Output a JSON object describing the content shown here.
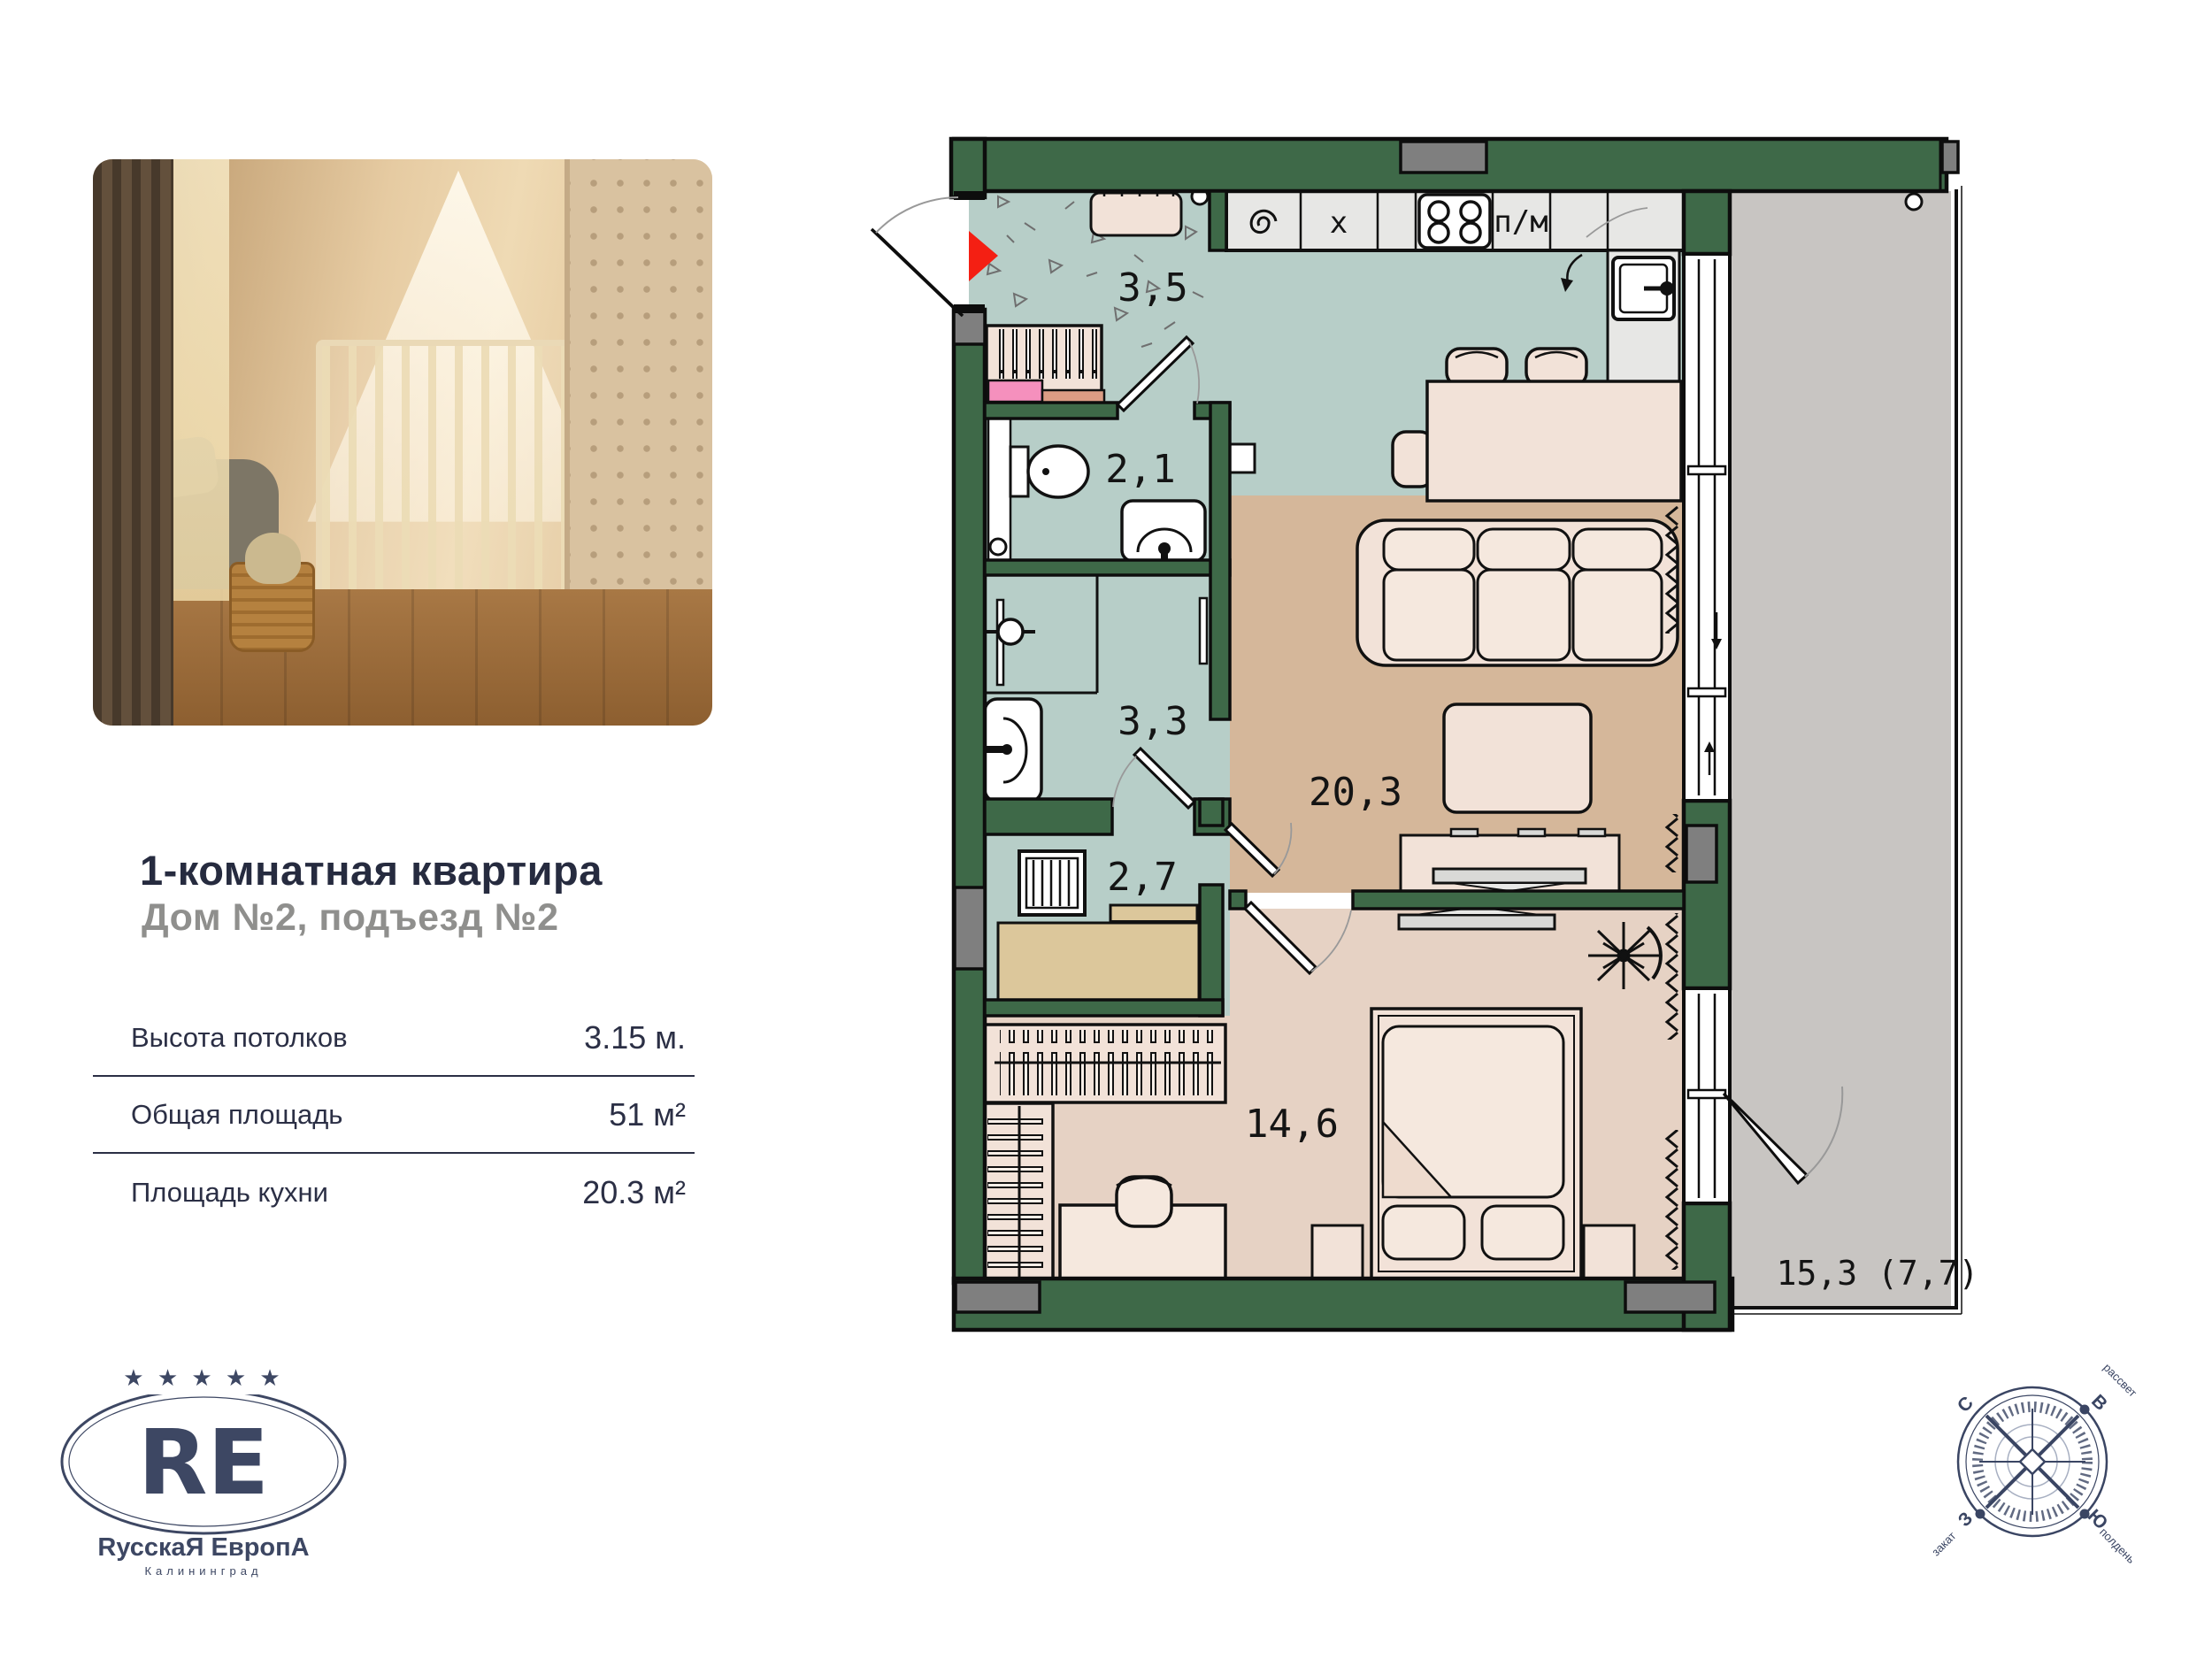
{
  "card": {
    "title": "1-комнатная квартира",
    "subtitle": "Дом №2, подъезд №2",
    "specs": [
      {
        "label": "Высота потолков",
        "value": "3.15 м."
      },
      {
        "label": "Общая площадь",
        "value": "51 м²"
      },
      {
        "label": "Площадь кухни",
        "value": "20.3 м²"
      }
    ]
  },
  "logo": {
    "stars": "★ ★ ★ ★ ★",
    "monogram": "RE",
    "name": "RусскаЯ ЕвропА",
    "city": "Калининград"
  },
  "plan": {
    "rooms": [
      {
        "id": "hallway",
        "label": "3,5"
      },
      {
        "id": "bathroom",
        "label": "2,1"
      },
      {
        "id": "shower-room",
        "label": "3,3"
      },
      {
        "id": "storage",
        "label": "2,7"
      },
      {
        "id": "kitchen-living",
        "label": "20,3"
      },
      {
        "id": "bedroom",
        "label": "14,6"
      },
      {
        "id": "balcony",
        "label": "15,3 (7,7)"
      }
    ],
    "kitchen": {
      "dishwasher": "п/м",
      "appliance_x": "x"
    },
    "compass": {
      "north": "С",
      "east": "В",
      "west": "З",
      "south": "Ю",
      "dawn": "рассвет",
      "sunset": "закат",
      "noon": "полдень"
    },
    "colors": {
      "wall_green": "#3e6948",
      "wet_floor": "#b7cec8",
      "living_floor": "#d5b79a",
      "bedroom_floor": "#e6d2c4",
      "balcony_floor": "#c8c5c2",
      "furniture": "#f2e2d8",
      "counter": "#e7e7e5",
      "cabinet_beige": "#dcc79b",
      "shaft_gray": "#7f7f7f",
      "entry_red": "#f41f13",
      "navy": "#262b3f",
      "logo_navy": "#3d4763"
    }
  }
}
